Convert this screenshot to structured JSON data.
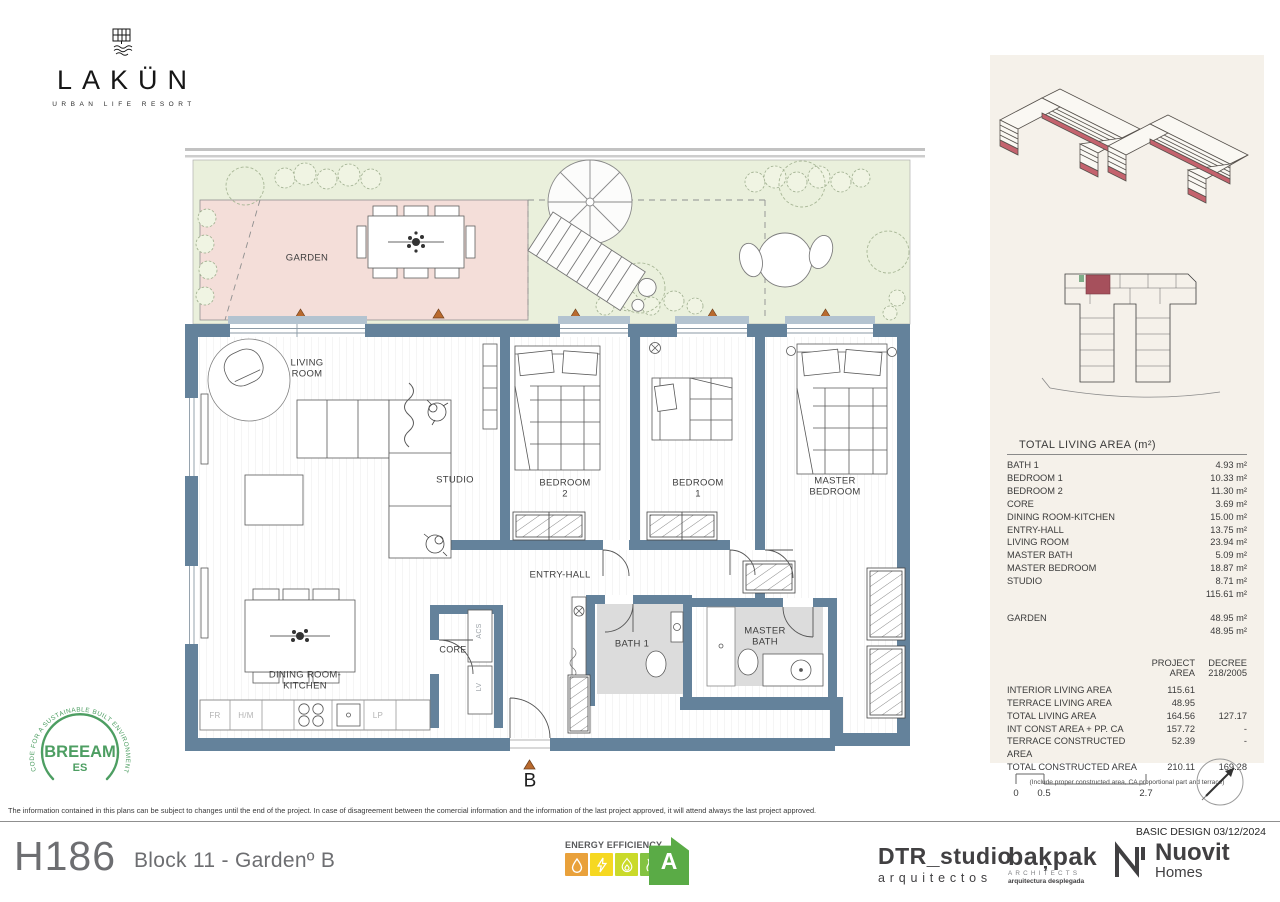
{
  "brand": {
    "name": "LAKÜN",
    "subtitle": "URBAN LIFE RESORT"
  },
  "plan": {
    "labels": {
      "garden": "GARDEN",
      "living_room": "LIVING ROOM",
      "studio": "STUDIO",
      "bedroom_2": "BEDROOM 2",
      "bedroom_1": "BEDROOM 1",
      "master_bedroom": "MASTER BEDROOM",
      "entry_hall": "ENTRY-HALL",
      "core": "CORE",
      "dining": "DINING ROOM-KITCHEN",
      "bath_1": "BATH 1",
      "master_bath": "MASTER BATH",
      "acs": "ACS",
      "lv": "LV",
      "fr": "FR",
      "hm": "H/M",
      "lp": "LP",
      "entry_marker": "B"
    }
  },
  "sidebar": {
    "living_table": {
      "title": "TOTAL LIVING AREA (m²)",
      "rows": [
        {
          "label": "BATH 1",
          "value": "4.93 m²"
        },
        {
          "label": "BEDROOM 1",
          "value": "10.33 m²"
        },
        {
          "label": "BEDROOM 2",
          "value": "11.30 m²"
        },
        {
          "label": "CORE",
          "value": "3.69 m²"
        },
        {
          "label": "DINING ROOM-KITCHEN",
          "value": "15.00 m²"
        },
        {
          "label": "ENTRY-HALL",
          "value": "13.75 m²"
        },
        {
          "label": "LIVING ROOM",
          "value": "23.94 m²"
        },
        {
          "label": "MASTER BATH",
          "value": "5.09 m²"
        },
        {
          "label": "MASTER BEDROOM",
          "value": "18.87 m²"
        },
        {
          "label": "STUDIO",
          "value": "8.71 m²"
        },
        {
          "label": "",
          "value": "115.61 m²"
        },
        {
          "label": "GARDEN",
          "value": "48.95 m²"
        },
        {
          "label": "",
          "value": "48.95 m²"
        }
      ]
    },
    "project_table": {
      "col1_header": "PROJECT\nAREA",
      "col2_header": "DECREE\n218/2005",
      "rows": [
        {
          "label": "INTERIOR LIVING AREA",
          "project": "115.61",
          "decree": ""
        },
        {
          "label": "TERRACE LIVING AREA",
          "project": "48.95",
          "decree": ""
        },
        {
          "label": "TOTAL LIVING AREA",
          "project": "164.56",
          "decree": "127.17"
        },
        {
          "label": "INT CONST AREA + PP. CA",
          "project": "157.72",
          "decree": "-"
        },
        {
          "label": "TERRACE CONSTRUCTED AREA",
          "project": "52.39",
          "decree": "-"
        },
        {
          "label": "TOTAL CONSTRUCTED AREA",
          "project": "210.11",
          "decree": "169.28"
        }
      ],
      "footnote": "(Include proper constructed area, CA proportional part and terrace)"
    },
    "scale": {
      "t0": "0",
      "t1": "0.5",
      "t2": "2.7"
    }
  },
  "breeam": {
    "arc_text": "CODE FOR A SUSTAINABLE BUILT ENVIRONMENT",
    "title": "BREEAM",
    "region": "ES"
  },
  "disclaimer": "The information contained in this plans can be subject to changes until the end of the project. In case of disagreement between the comercial information and the information of the last project approved, it will attend always the last project approved.",
  "basic_design": "BASIC DESIGN 03/12/2024",
  "footer": {
    "unit_code": "H186",
    "unit_name": "Block 11 -  Gardenº B",
    "energy": {
      "label": "ENERGY EFFICIENCY",
      "rating": "A"
    },
    "dtr": {
      "line1": "DTR_studio",
      "line2": "arquitectos"
    },
    "bakpak": {
      "name": "baķpak",
      "sub1": "ARCHITECTS",
      "sub2": "arquitectura desplegada"
    },
    "nuovit": {
      "name": "Nuovit",
      "sub": "Homes"
    }
  },
  "colors": {
    "wall_blue": "#64829b",
    "garden_green": "#eaf0dc",
    "garden_pink": "#f4ded9",
    "highlight_red": "#a6505c",
    "panel_beige": "#f5f1ea",
    "breeam_green": "#4d9e62",
    "energy_orange": "#e9a13b",
    "energy_yellow": "#f6d821",
    "energy_lime": "#cada2a",
    "energy_green": "#83c341",
    "energy_arrow": "#5aab46"
  }
}
